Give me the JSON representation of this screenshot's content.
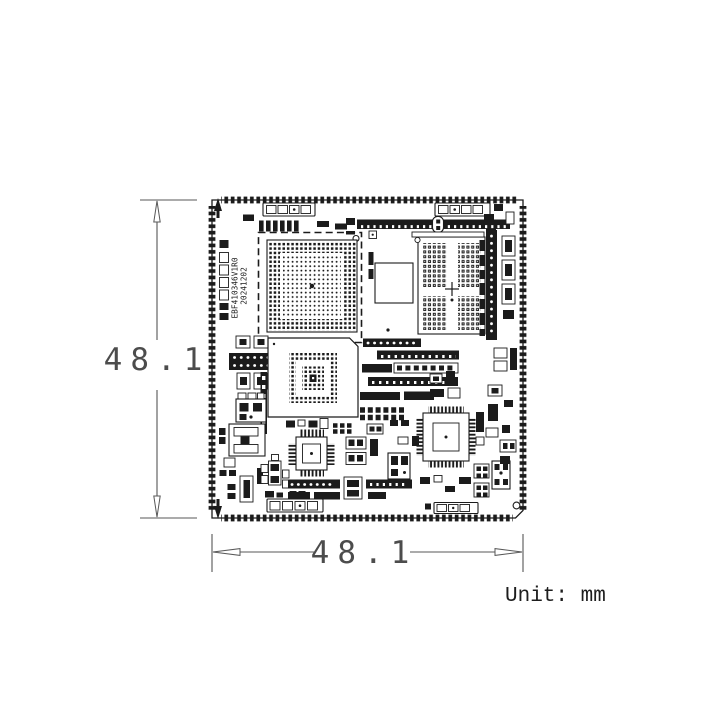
{
  "drawing": {
    "type": "pcb-mechanical-drawing",
    "unit_label": "Unit: mm",
    "dimensions": {
      "height_label": "48.1",
      "width_label": "48.1"
    },
    "board": {
      "part_number": "EBF410346V1R0",
      "date_code": "20241202"
    },
    "colors": {
      "board_line": "#1b1b1b",
      "dimension_line": "#575757",
      "dimension_text": "#4c4c4c",
      "background": "#ffffff"
    }
  }
}
